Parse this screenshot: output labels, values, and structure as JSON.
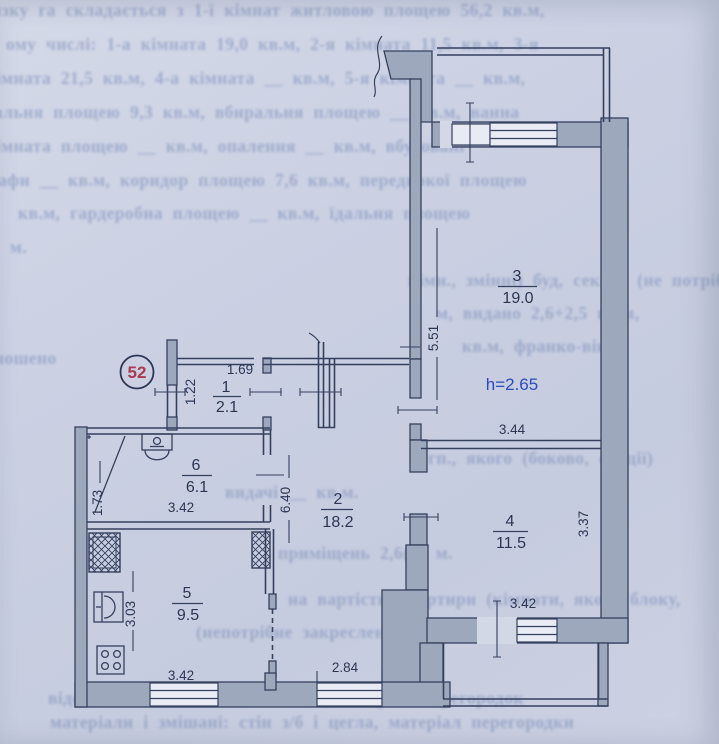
{
  "badge": {
    "number": "52"
  },
  "labels": {
    "height": "h=2.65"
  },
  "rooms": [
    {
      "num": "1",
      "area": "2.1"
    },
    {
      "num": "2",
      "area": "18.2"
    },
    {
      "num": "3",
      "area": "19.0"
    },
    {
      "num": "4",
      "area": "11.5"
    },
    {
      "num": "5",
      "area": "9.5"
    },
    {
      "num": "6",
      "area": "6.1"
    }
  ],
  "dims": {
    "d169": "1.69",
    "d122": "1.22",
    "d551": "5.51",
    "d344": "3.44",
    "d337": "3.37",
    "d640": "6.40",
    "d173": "1.73",
    "d303": "3.03",
    "d284": "2.84",
    "d342a": "3.42",
    "d342b": "3.42",
    "d342c": "3.42"
  },
  "colors": {
    "paper": "#cbd1e3",
    "plan_line": "#35405e",
    "wall_fill": "#9ea8bd",
    "height_label": "#2a4ac4",
    "badge_number": "#a93a50"
  },
  "bleed_lines": [
    {
      "x": -8,
      "y": 0,
      "t": "язку га складається з 1-ї кімнат житловою площею 56,2 кв.м,"
    },
    {
      "x": 6,
      "y": 34,
      "t": "ому числі: 1-а кімната 19,0 кв.м, 2-я кімната 11,5 кв.м, 3-я"
    },
    {
      "x": -4,
      "y": 68,
      "t": "імната 21,5 кв.м, 4-а кімната __ кв.м, 5-я кімната __ кв.м,"
    },
    {
      "x": -6,
      "y": 102,
      "t": "альня площею 9,3 кв.м, вбиральня площею __ кв.м, ванна"
    },
    {
      "x": -4,
      "y": 136,
      "t": "імната площею __ кв.м, опалення __ кв.м, вбудовані"
    },
    {
      "x": -2,
      "y": 170,
      "t": "афи __ кв.м, коридор площею 7,6 кв.м, передпокої площею"
    },
    {
      "x": 18,
      "y": 203,
      "t": "кв.м, гардеробна площею __ кв.м, їдальня площею"
    },
    {
      "x": 10,
      "y": 237,
      "t": "м."
    },
    {
      "x": 408,
      "y": 270,
      "t": "кімн., змінні) буд, секції) (не потрібне"
    },
    {
      "x": 436,
      "y": 303,
      "t": "м, видано 2,6+2,5 кв.м,"
    },
    {
      "x": 462,
      "y": 336,
      "t": "кв.м, франко-вікон"
    },
    {
      "x": -6,
      "y": 348,
      "t": "ношено"
    },
    {
      "x": 428,
      "y": 448,
      "t": "гп., якого (боково, секції)"
    },
    {
      "x": 225,
      "y": 482,
      "t": "видачі __ кв.м."
    },
    {
      "x": 278,
      "y": 543,
      "t": "приміщень 2,6(н) м."
    },
    {
      "x": 288,
      "y": 589,
      "t": "на вартість квартири (кімнати, якого блоку,"
    },
    {
      "x": 196,
      "y": 622,
      "t": "(непотрібне закреслені) не визначалась"
    },
    {
      "x": 48,
      "y": 688,
      "t": "відомості: кімнати, стін і вікон, матеріал перегородок"
    },
    {
      "x": 50,
      "y": 712,
      "t": "матеріали і змішані: стін з/б і цегла, матеріал перегородки"
    }
  ]
}
